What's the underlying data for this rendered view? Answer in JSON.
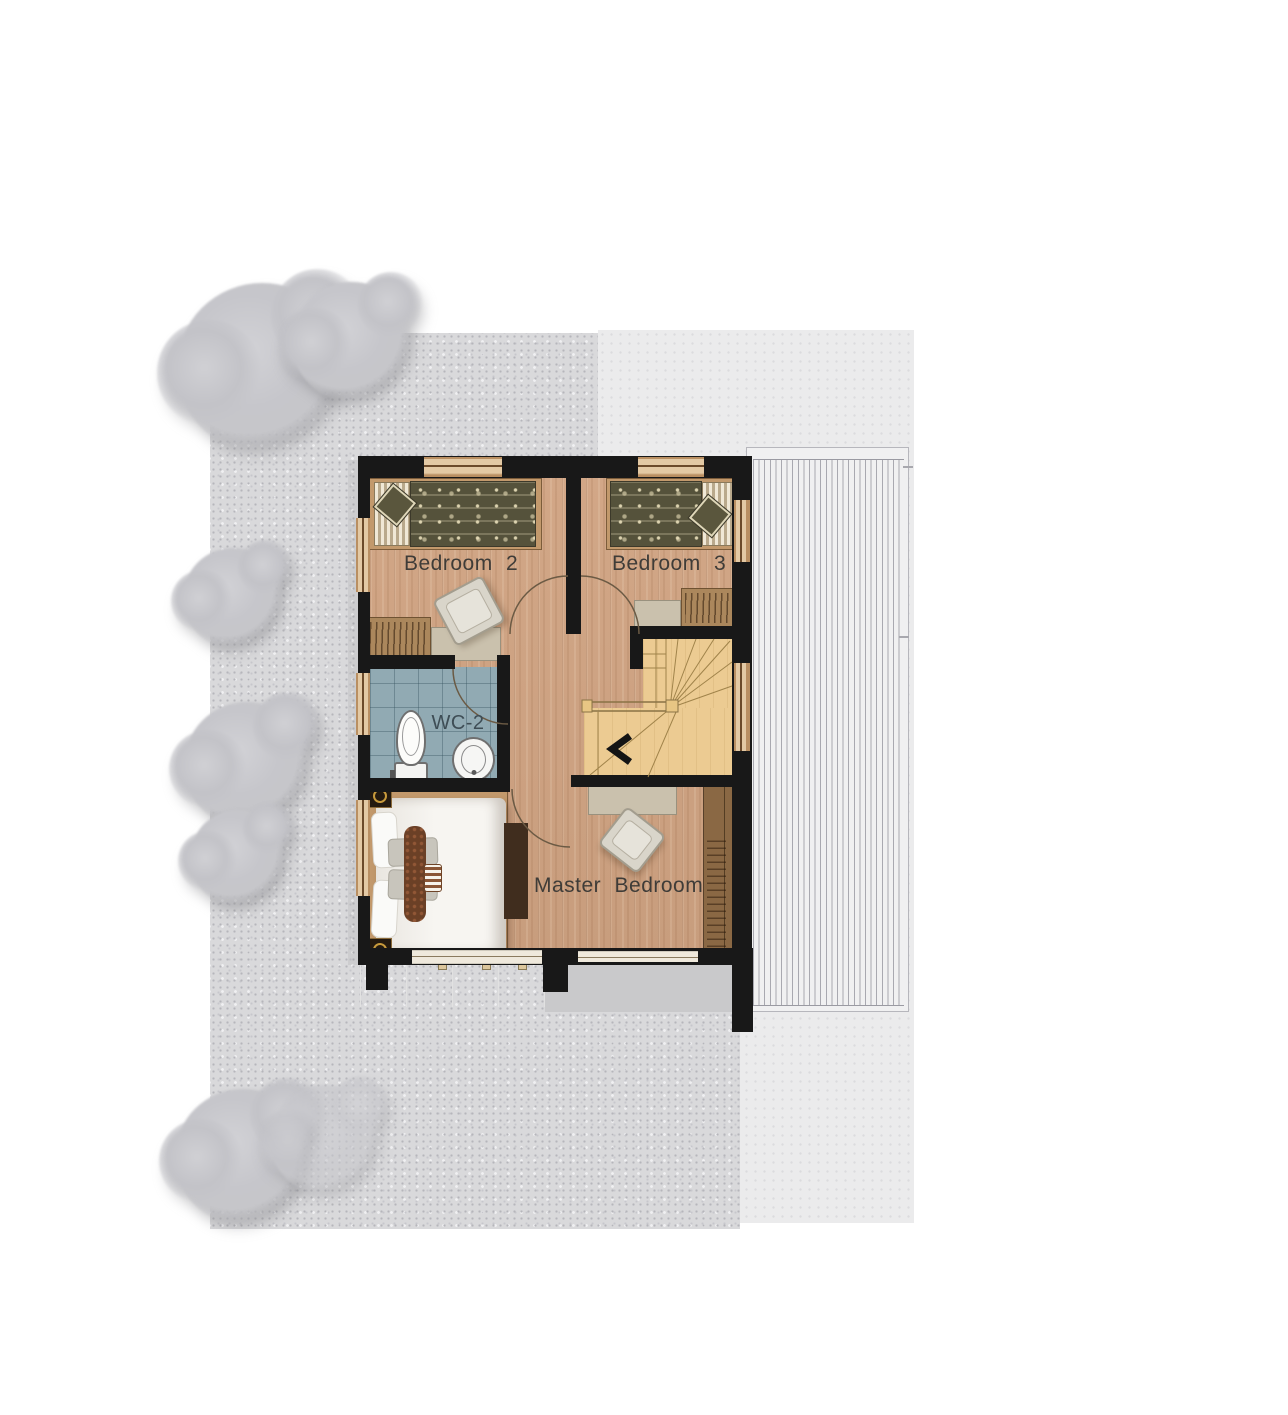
{
  "plan": {
    "type": "residential floor plan",
    "rooms": [
      {
        "id": "bedroom-2",
        "label": "Bedroom 2"
      },
      {
        "id": "bedroom-3",
        "label": "Bedroom 3"
      },
      {
        "id": "wc-2",
        "label": "WC-2"
      },
      {
        "id": "master-bedroom",
        "label": "Master Bedroom"
      }
    ],
    "features": [
      "two single beds",
      "king bed",
      "toilet",
      "sink",
      "u-turn staircase with winders",
      "wardrobes",
      "desks with chairs",
      "balcony",
      "lower roof deck",
      "gravel yard with trees"
    ],
    "icons": {
      "stair_direction": "chevron-left-icon"
    }
  },
  "colors": {
    "wall": "#181818",
    "wood_floor": "#cda184",
    "stair_wood": "#eccb92",
    "bathroom_tile": "#91aab3",
    "duvet_olive": "#55523b",
    "furniture_beige": "#cac1ad",
    "wardrobe_brown": "#8a6844",
    "gravel": "#d9d9db",
    "driveway": "#ebebec",
    "roof_deck": "#f0f0f1",
    "tree": "#c6c6ca",
    "label_text": "#3f3c38"
  }
}
